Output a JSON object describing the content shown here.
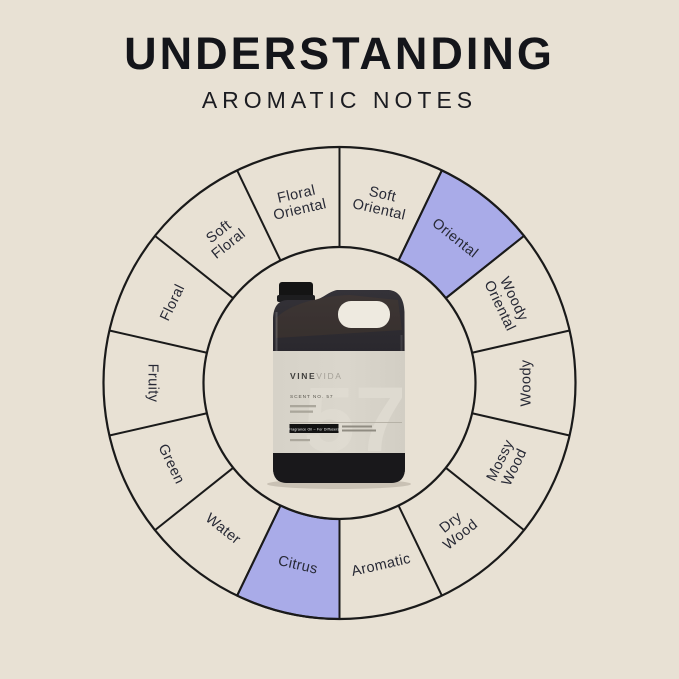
{
  "page": {
    "background": "#e8e1d4"
  },
  "header": {
    "title": "UNDERSTANDING",
    "subtitle": "AROMATIC NOTES"
  },
  "wheel": {
    "stroke_color": "#1a1a1a",
    "segment_fill": "#e8e1d4",
    "highlight_fill": "#a9abe8",
    "label_color": "#272935",
    "segments": [
      {
        "label": "Soft Oriental",
        "lines": [
          "Soft",
          "Oriental"
        ],
        "highlighted": false
      },
      {
        "label": "Oriental",
        "lines": [
          "Oriental"
        ],
        "highlighted": true
      },
      {
        "label": "Woody Oriental",
        "lines": [
          "Woody",
          "Oriental"
        ],
        "highlighted": false
      },
      {
        "label": "Woody",
        "lines": [
          "Woody"
        ],
        "highlighted": false
      },
      {
        "label": "Mossy Wood",
        "lines": [
          "Mossy",
          "Wood"
        ],
        "highlighted": false
      },
      {
        "label": "Dry Wood",
        "lines": [
          "Dry",
          "Wood"
        ],
        "highlighted": false
      },
      {
        "label": "Aromatic",
        "lines": [
          "Aromatic"
        ],
        "highlighted": false
      },
      {
        "label": "Citrus",
        "lines": [
          "Citrus"
        ],
        "highlighted": true
      },
      {
        "label": "Water",
        "lines": [
          "Water"
        ],
        "highlighted": false
      },
      {
        "label": "Green",
        "lines": [
          "Green"
        ],
        "highlighted": false
      },
      {
        "label": "Fruity",
        "lines": [
          "Fruity"
        ],
        "highlighted": false
      },
      {
        "label": "Floral",
        "lines": [
          "Floral"
        ],
        "highlighted": false
      },
      {
        "label": "Soft Floral",
        "lines": [
          "Soft",
          "Floral"
        ],
        "highlighted": false
      },
      {
        "label": "Floral Oriental",
        "lines": [
          "Floral",
          "Oriental"
        ],
        "highlighted": false
      }
    ]
  },
  "product": {
    "brand_bold": "VINE",
    "brand_light": "VIDA",
    "scent_line": "SCENT NO. 57",
    "watermark": "57",
    "badge": "Fragrance Oil – For Diffusers"
  }
}
